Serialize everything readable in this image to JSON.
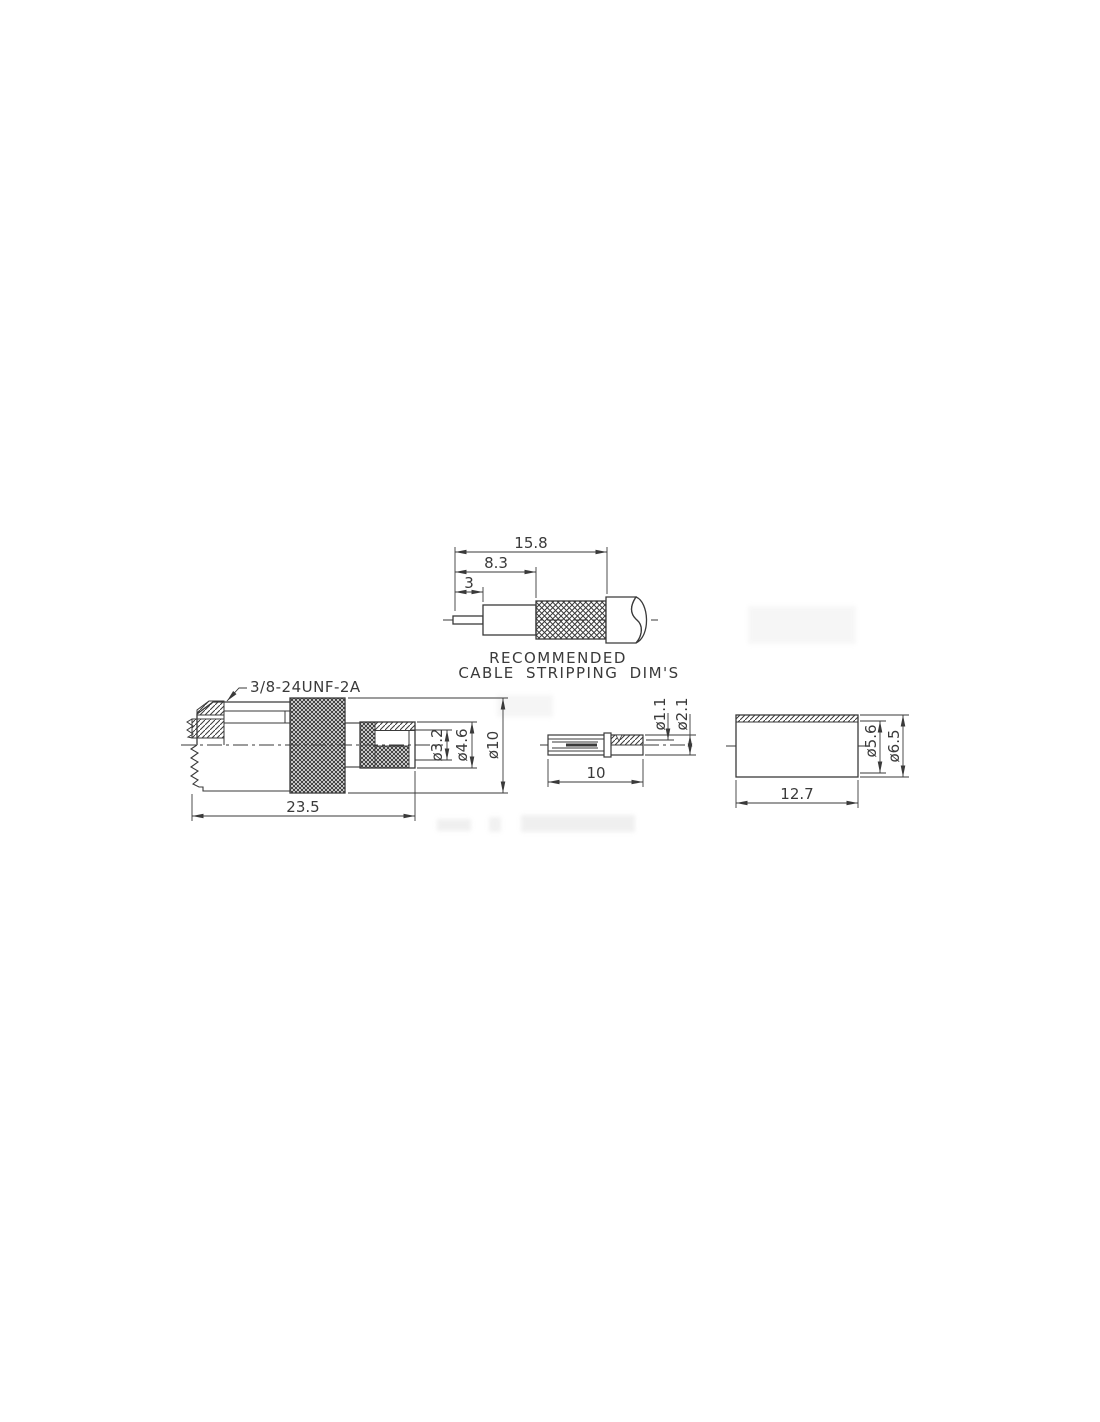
{
  "meta": {
    "background_color": "#ffffff",
    "ink_color": "#3a3a3a",
    "drawing_type": "connector-dimension-drawing"
  },
  "cable_stripping": {
    "dim_overall": "15.8",
    "dim_braid": "8.3",
    "dim_center": "3",
    "caption_line1": "RECOMMENDED",
    "caption_line2": "CABLE STRIPPING DIM'S"
  },
  "connector_body": {
    "thread_label": "3/8-24UNF-2A",
    "dim_bore_dia": "ø3.2",
    "dim_crimp_dia": "ø4.6",
    "dim_body_dia": "ø10",
    "dim_length": "23.5"
  },
  "center_pin": {
    "dim_bore_dia": "ø1.1",
    "dim_outer_dia": "ø2.1",
    "dim_length": "10"
  },
  "crimp_ferrule": {
    "dim_inner_dia": "ø5.6",
    "dim_outer_dia": "ø6.5",
    "dim_length": "12.7"
  }
}
